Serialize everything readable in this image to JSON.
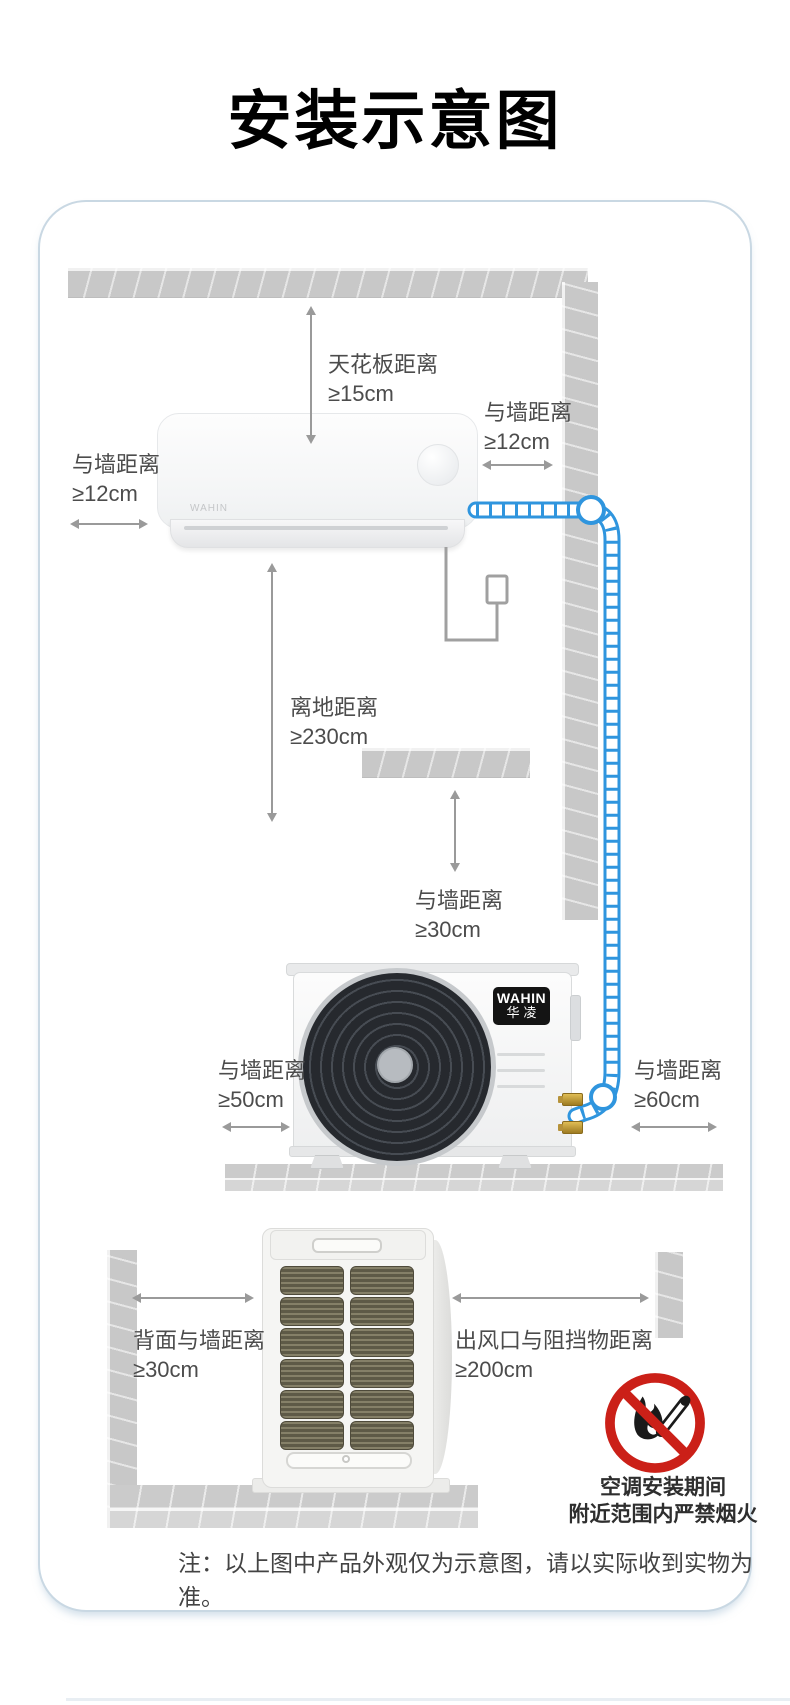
{
  "title": "安装示意图",
  "panel": {
    "indoor": {
      "ceiling_label": {
        "name": "天花板距离",
        "value": "≥15cm"
      },
      "left_label": {
        "name": "与墙距离",
        "value": "≥12cm"
      },
      "right_label": {
        "name": "与墙距离",
        "value": "≥12cm"
      },
      "floor_label": {
        "name": "离地距离",
        "value": "≥230cm"
      },
      "unit_brand": "WAHIN"
    },
    "outdoor": {
      "top_label": {
        "name": "与墙距离",
        "value": "≥30cm"
      },
      "left_label": {
        "name": "与墙距离",
        "value": "≥50cm"
      },
      "right_label": {
        "name": "与墙距离",
        "value": "≥60cm"
      },
      "brand_en": "WAHIN",
      "brand_cn": "华凌"
    },
    "top_view": {
      "back_label": {
        "name": "背面与墙距离",
        "value": "≥30cm"
      },
      "outlet_label": {
        "name": "出风口与阻挡物距离",
        "value": "≥200cm"
      },
      "fire_warning_line1": "空调安装期间",
      "fire_warning_line2": "附近范围内严禁烟火"
    },
    "note": "注：以上图中产品外观仅为示意图，请以实际收到实物为准。"
  },
  "colors": {
    "pipe_blue": "#2f95de",
    "warning_red": "#cb2018",
    "beam_gray": "#c8c8c8",
    "arrow_gray": "#999999",
    "label_gray": "#4c4c4c",
    "brass": "#c09a3e",
    "logo_black": "#141414"
  }
}
